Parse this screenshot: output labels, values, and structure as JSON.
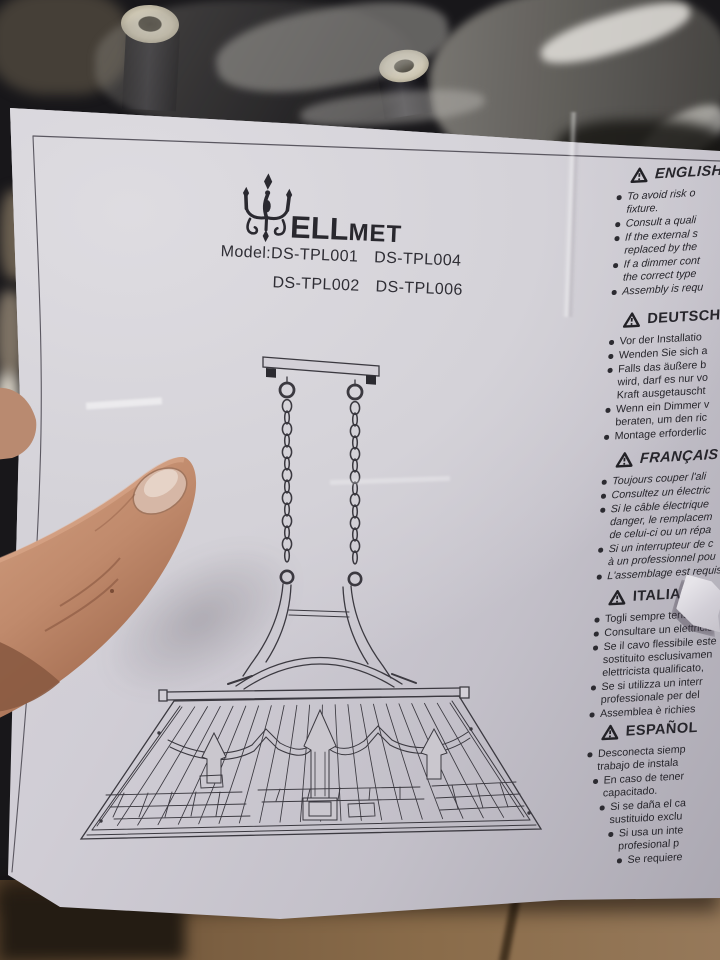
{
  "brand": {
    "logo_icon": "chandelier-icon",
    "logo_text_large": "ELL",
    "logo_text_small": "MET"
  },
  "model": {
    "label": "Model:",
    "row1": [
      "DS-TPL001",
      "DS-TPL004"
    ],
    "row2": [
      "DS-TPL002",
      "DS-TPL006"
    ]
  },
  "sections": [
    {
      "title": "ENGLISH",
      "italic": true,
      "items": [
        [
          "To avoid risk o",
          "fixture."
        ],
        [
          "Consult a quali"
        ],
        [
          "If the external s",
          "replaced by the"
        ],
        [
          "If a dimmer cont",
          "the correct type"
        ],
        [
          "Assembly is requ"
        ]
      ]
    },
    {
      "title": "DEUTSCH",
      "italic": false,
      "items": [
        [
          "Vor der Installatio"
        ],
        [
          "Wenden Sie sich a"
        ],
        [
          "Falls das äußere b",
          "wird, darf es nur vo",
          "Kraft ausgetauscht"
        ],
        [
          "Wenn ein Dimmer v",
          "beraten, um den ric"
        ],
        [
          "Montage erforderlic"
        ]
      ]
    },
    {
      "title": "FRANÇAIS",
      "italic": true,
      "items": [
        [
          "Toujours couper l'ali"
        ],
        [
          "Consultez un électric"
        ],
        [
          "Si le câble électrique",
          "danger, le remplacem",
          "de celui-ci ou un répa"
        ],
        [
          "Si un interrupteur de c",
          "à un professionnel pou"
        ],
        [
          "L'assemblage est requis"
        ]
      ]
    },
    {
      "title": "ITALIANO",
      "italic": false,
      "items": [
        [
          "Togli sempre tensione"
        ],
        [
          "Consultare un elettricis"
        ],
        [
          "Se il cavo flessibile este",
          "sostituito esclusivamen",
          "elettricista qualificato,"
        ],
        [
          "Se si utilizza un interr",
          "professionale per del"
        ],
        [
          "Assemblea è richies"
        ]
      ]
    },
    {
      "title": "ESPAÑOL",
      "italic": false,
      "items": [
        [
          "Desconecta siemp",
          "trabajo de instala"
        ],
        [
          "En caso de tener",
          "capacitado."
        ],
        [
          "Si se daña el ca",
          "sustituido exclu"
        ],
        [
          "Si usa un inte",
          "profesional p"
        ],
        [
          "Se requiere"
        ]
      ]
    }
  ],
  "colors": {
    "paper": "#d2cfd6",
    "ink": "#2c2b31",
    "cardboard": "#7c5f41",
    "skin": "#c08b6e",
    "socket_cream": "#d6d0bd"
  }
}
